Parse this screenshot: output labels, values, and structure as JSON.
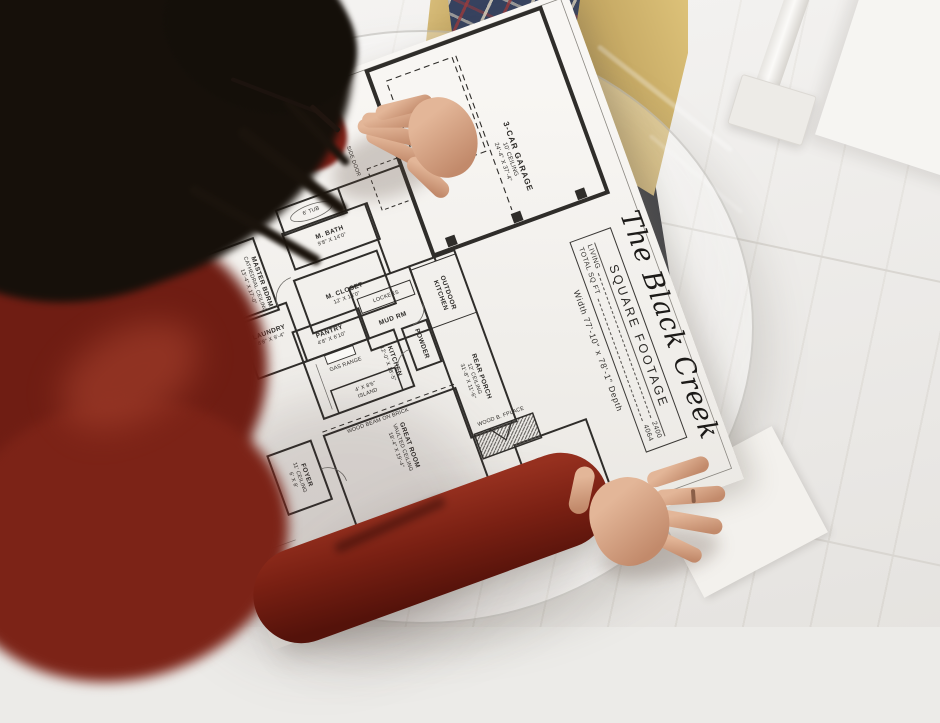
{
  "blueprint": {
    "plan_title": "The Black Creek",
    "square_footage_box": {
      "heading": "SQUARE FOOTAGE",
      "rows": [
        {
          "label": "LIVING",
          "value": "2400"
        },
        {
          "label": "TOTAL SQ FT",
          "value": "4064"
        }
      ]
    },
    "overall_dimensions": "Width 77'-10\" x 78'-1\" Depth",
    "rooms": [
      {
        "lines": [
          "M. BATH",
          "9'8\" X 14'0\""
        ]
      },
      {
        "lines": [
          "6' TUB"
        ]
      },
      {
        "lines": [
          "M. CLOSET",
          "12' X 14'0\""
        ]
      },
      {
        "lines": [
          "MASTER BDRM",
          "CATHEDRAL CEILING",
          "13'-4\" X 17'-0\""
        ]
      },
      {
        "lines": [
          "LAUNDRY",
          "8'8\" X 9'-4\""
        ]
      },
      {
        "lines": [
          "PANTRY",
          "4'8\" X 6'10\""
        ]
      },
      {
        "lines": [
          "GAS RANGE"
        ]
      },
      {
        "lines": [
          "4' X 8'6\"",
          "ISLAND"
        ]
      },
      {
        "lines": [
          "KITCHEN",
          "12'-0\" X 18'-5\""
        ]
      },
      {
        "lines": [
          "POWDER"
        ]
      },
      {
        "lines": [
          "LOCKERS"
        ]
      },
      {
        "lines": [
          "MUD RM"
        ]
      },
      {
        "lines": [
          "SIDE DOOR"
        ]
      },
      {
        "lines": [
          "3-CAR GARAGE",
          "10' CEILING",
          "24'-4\" X 37'-4\""
        ]
      },
      {
        "lines": [
          "OUTDOOR",
          "KITCHEN"
        ]
      },
      {
        "lines": [
          "REAR PORCH",
          "12' CEILING",
          "31'-8\" X 11'-6\""
        ]
      },
      {
        "lines": [
          "GREAT ROOM",
          "VAULTED CEILING",
          "18'-4\" X 19'-4\""
        ]
      },
      {
        "lines": [
          "WOOD B. FPLACE"
        ]
      },
      {
        "lines": [
          "WOOD BEAM ON BRICK"
        ]
      },
      {
        "lines": [
          "FOYER",
          "11' CEILING",
          "6' X 8'"
        ]
      },
      {
        "lines": [
          "BEDROOM"
        ]
      }
    ]
  },
  "colors": {
    "sweater_red": "#7a2013",
    "hair_black": "#16100a",
    "floor_white": "#ecebe8",
    "paper_white": "#f5f3f0",
    "plan_ink": "#2f2d2a",
    "jacket_tan": "#d9be7b",
    "pants_black": "#191a1f",
    "plaid_navy": "#36425f",
    "skin": "#d8a88c"
  }
}
